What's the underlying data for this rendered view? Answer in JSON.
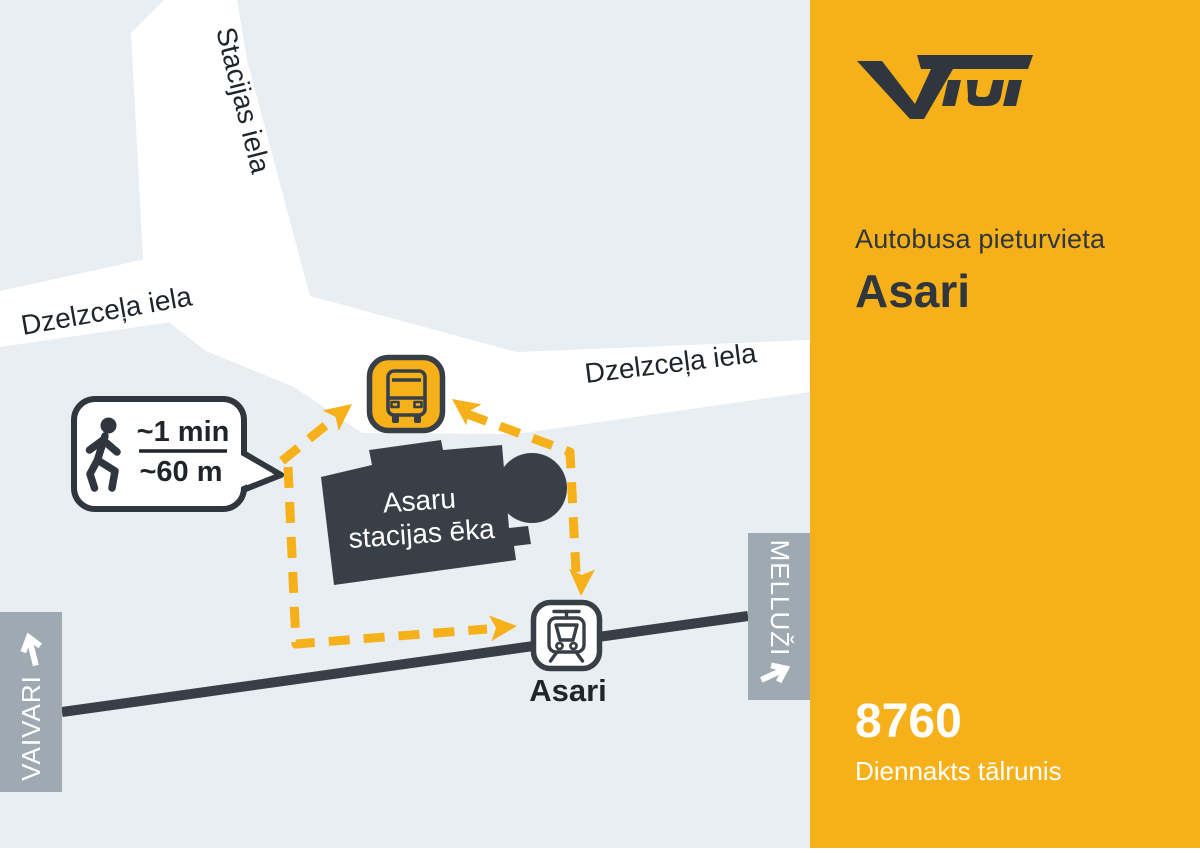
{
  "sidebar": {
    "brand": "VIDI",
    "subtitle": "Autobusa pieturvieta",
    "title": "Asari",
    "phone_number": "8760",
    "phone_caption": "Diennakts tālrunis"
  },
  "map": {
    "street_top": "Stacijas iela",
    "street_left": "Dzelzceļa iela",
    "street_right": "Dzelzceļa iela",
    "building": {
      "line1": "Asaru",
      "line2": "stacijas ēka"
    },
    "train_station_label": "Asari",
    "walk_badge": {
      "time": "~1 min",
      "distance": "~60 m"
    },
    "rail_direction_left": "VAIVARI",
    "rail_direction_right": "MELLUŽI"
  },
  "icons": {
    "logo": "vidi-logo",
    "bus": "bus-stop-icon",
    "train": "train-station-icon",
    "walker": "walking-person-icon",
    "arrow_left": "direction-arrow-up-icon",
    "arrow_right": "direction-arrow-right-icon"
  },
  "colors": {
    "accent_orange": "#F6B11A",
    "dark": "#383F46",
    "logo_dark": "#2F363D",
    "map_background": "#E8EEF1",
    "street_white": "#FFFFFF",
    "direction_box_gray": "#9FA9B1",
    "label_text": "#1F252A"
  }
}
